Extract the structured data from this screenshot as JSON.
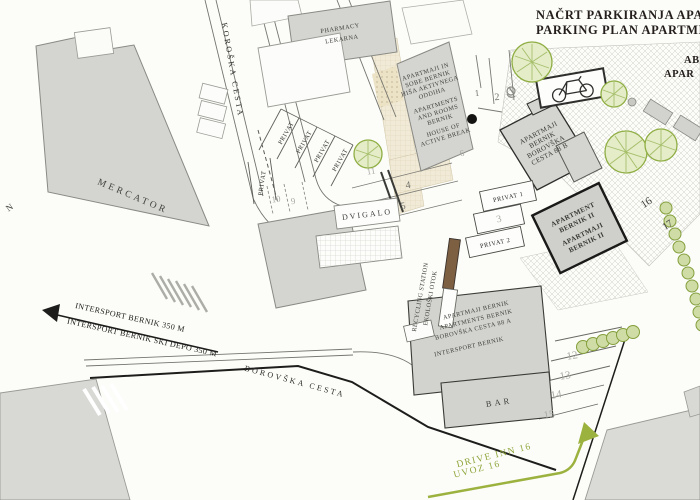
{
  "title": {
    "line1": "NAČRT PARKIRANJA APARTMA",
    "line2": "PARKING PLAN APARTMENTS"
  },
  "corner": {
    "line1": "AB",
    "line2": "APAR"
  },
  "edge_fragment": "N",
  "streets": {
    "koroska": "KOROŠKA CESTA",
    "borovska": "BOROVŠKA CESTA"
  },
  "buildings": {
    "pharmacy": {
      "lines": [
        "PHARMACY",
        "LEKARNA"
      ]
    },
    "mercator": {
      "label": "MERCATOR"
    },
    "house_active_break": {
      "lines": [
        "APARTMAJI IN",
        "SOBE BERNIK",
        "HIŠA AKTIVNEGA",
        "ODDIHA",
        "APARTMENTS",
        "AND ROOMS",
        "BERNIK",
        "HOUSE OF",
        "ACTIVE BREAK"
      ]
    },
    "bernik_88b": {
      "lines": [
        "APARTMAJI",
        "BERNIK",
        "BOROVŠKA",
        "CESTA 88 B"
      ]
    },
    "bernik_ii": {
      "lines": [
        "APARTMENT",
        "BERNIK II",
        "APARTMAJI",
        "BERNIK II"
      ]
    },
    "bernik_88a": {
      "lines": [
        "APARTMAJI BERNIK",
        "APARTMENTS BERNIK",
        "BOROVŠKA CESTA 88 A",
        "INTERSPORT BERNIK"
      ]
    },
    "bar": {
      "label": "BAR"
    }
  },
  "facilities": {
    "dvigalo": "DVIGALO",
    "recycling_en": "RECYCLING STATION",
    "recycling_sl": "EKOLOŠKI OTOK"
  },
  "parking": {
    "privat": "PRIVAT",
    "privat1": "PRIVAT 1",
    "privat2": "PRIVAT 2",
    "spots": {
      "s1": "1",
      "s2": "2",
      "s3": "3",
      "s4": "4",
      "s5": "5",
      "s6": "6",
      "s9": "9",
      "s10": "10",
      "s11": "11",
      "s12": "12",
      "s13": "13",
      "s14": "14",
      "s15": "15",
      "s16": "16",
      "s17": "17"
    }
  },
  "directions": {
    "intersport": "INTERSPORT BERNIK  350 M",
    "intersport_ski": "INTERSPORT BERNIK SKI DEPO  350 M",
    "drive_inn": "DRIVE INN 16",
    "uvoz": "UVOZ 16"
  },
  "colors": {
    "building_gray": "#d4d4d1",
    "accent_green": "#8fa73c",
    "beige": "#f1ead6",
    "recycling_brown": "#7d5f42",
    "ink": "#241f1c"
  }
}
